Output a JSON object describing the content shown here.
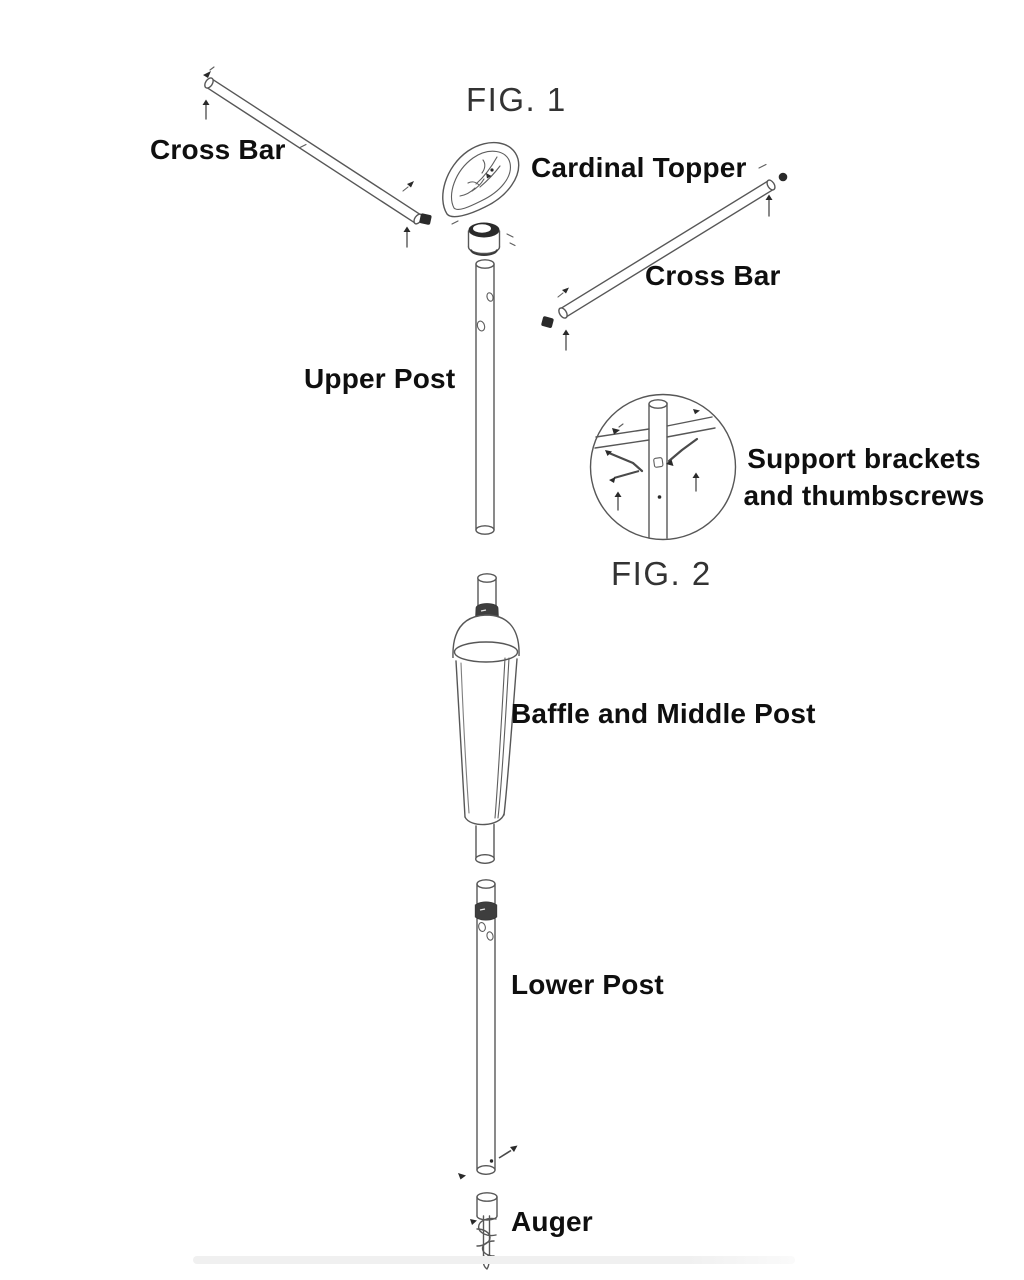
{
  "figures": {
    "fig1": "FIG. 1",
    "fig2": "FIG. 2"
  },
  "parts": {
    "cross_bar_left": "Cross Bar",
    "cardinal_topper": "Cardinal Topper",
    "cross_bar_right": "Cross Bar",
    "upper_post": "Upper Post",
    "support_brackets_line1": "Support brackets",
    "support_brackets_line2": "and thumbscrews",
    "baffle_middle_post": "Baffle and Middle Post",
    "lower_post": "Lower Post",
    "auger": "Auger"
  },
  "colors": {
    "background": "#ffffff",
    "line_art": "#575757",
    "label_text": "#0f0f0f",
    "figure_text": "#333333",
    "hardware_fill": "#2a2a2a",
    "footer_bar": "#f0f0f0"
  }
}
